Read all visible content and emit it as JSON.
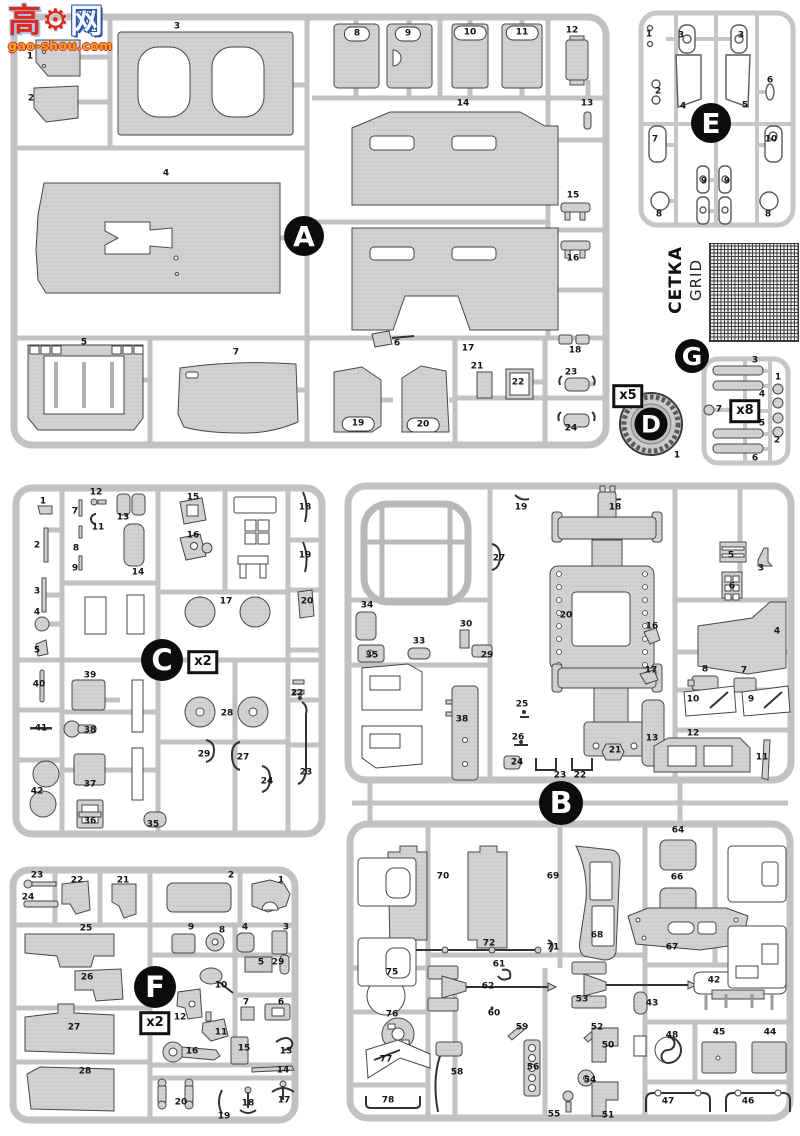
{
  "watermark": {
    "char_left": "高",
    "char_right": "网",
    "gear_glyph": "⚙",
    "url": "gao-shou.com"
  },
  "grid_part": {
    "label_cyrillic": "СЕТКА",
    "label_english": "GRID"
  },
  "sprues": {
    "a": {
      "letter": "A"
    },
    "b": {
      "letter": "B"
    },
    "c": {
      "letter": "C",
      "multiplier": "x2"
    },
    "d": {
      "letter": "D",
      "multiplier": "x5"
    },
    "e": {
      "letter": "E"
    },
    "f": {
      "letter": "F",
      "multiplier": "x2"
    },
    "g": {
      "letter": "G",
      "multiplier": "x8"
    }
  },
  "part_labels": [
    {
      "s": "A",
      "n": "1",
      "x": 30,
      "y": 57
    },
    {
      "s": "A",
      "n": "2",
      "x": 31,
      "y": 99
    },
    {
      "s": "A",
      "n": "3",
      "x": 177,
      "y": 27
    },
    {
      "s": "A",
      "n": "4",
      "x": 166,
      "y": 174
    },
    {
      "s": "A",
      "n": "5",
      "x": 84,
      "y": 343
    },
    {
      "s": "A",
      "n": "6",
      "x": 397,
      "y": 344
    },
    {
      "s": "A",
      "n": "7",
      "x": 236,
      "y": 353
    },
    {
      "s": "A",
      "n": "8",
      "x": 357,
      "y": 34,
      "pill": 1
    },
    {
      "s": "A",
      "n": "9",
      "x": 408,
      "y": 34,
      "pill": 1
    },
    {
      "s": "A",
      "n": "10",
      "x": 470,
      "y": 33,
      "pill": 1
    },
    {
      "s": "A",
      "n": "11",
      "x": 522,
      "y": 33,
      "pill": 1
    },
    {
      "s": "A",
      "n": "12",
      "x": 572,
      "y": 31
    },
    {
      "s": "A",
      "n": "13",
      "x": 587,
      "y": 104
    },
    {
      "s": "A",
      "n": "14",
      "x": 463,
      "y": 104
    },
    {
      "s": "A",
      "n": "15",
      "x": 573,
      "y": 196
    },
    {
      "s": "A",
      "n": "16",
      "x": 573,
      "y": 259
    },
    {
      "s": "A",
      "n": "17",
      "x": 468,
      "y": 349
    },
    {
      "s": "A",
      "n": "18",
      "x": 575,
      "y": 351
    },
    {
      "s": "A",
      "n": "19",
      "x": 358,
      "y": 424,
      "pill": 1
    },
    {
      "s": "A",
      "n": "20",
      "x": 423,
      "y": 425,
      "pill": 1
    },
    {
      "s": "A",
      "n": "21",
      "x": 477,
      "y": 367
    },
    {
      "s": "A",
      "n": "22",
      "x": 518,
      "y": 383
    },
    {
      "s": "A",
      "n": "23",
      "x": 571,
      "y": 373
    },
    {
      "s": "A",
      "n": "24",
      "x": 571,
      "y": 429
    },
    {
      "s": "E",
      "n": "1",
      "x": 649,
      "y": 35
    },
    {
      "s": "E",
      "n": "2",
      "x": 658,
      "y": 92
    },
    {
      "s": "E",
      "n": "3",
      "x": 681,
      "y": 36
    },
    {
      "s": "E",
      "n": "3",
      "x": 741,
      "y": 36
    },
    {
      "s": "E",
      "n": "4",
      "x": 683,
      "y": 107
    },
    {
      "s": "E",
      "n": "5",
      "x": 745,
      "y": 106
    },
    {
      "s": "E",
      "n": "6",
      "x": 770,
      "y": 81
    },
    {
      "s": "E",
      "n": "7",
      "x": 655,
      "y": 140
    },
    {
      "s": "E",
      "n": "8",
      "x": 659,
      "y": 215
    },
    {
      "s": "E",
      "n": "8",
      "x": 768,
      "y": 215
    },
    {
      "s": "E",
      "n": "9",
      "x": 704,
      "y": 182
    },
    {
      "s": "E",
      "n": "9",
      "x": 727,
      "y": 182
    },
    {
      "s": "E",
      "n": "10",
      "x": 771,
      "y": 140
    },
    {
      "s": "G",
      "n": "3",
      "x": 755,
      "y": 361
    },
    {
      "s": "G",
      "n": "1",
      "x": 778,
      "y": 378
    },
    {
      "s": "G",
      "n": "4",
      "x": 762,
      "y": 395
    },
    {
      "s": "G",
      "n": "7",
      "x": 719,
      "y": 410
    },
    {
      "s": "G",
      "n": "5",
      "x": 762,
      "y": 424
    },
    {
      "s": "G",
      "n": "2",
      "x": 777,
      "y": 441
    },
    {
      "s": "G",
      "n": "6",
      "x": 755,
      "y": 459
    },
    {
      "s": "D",
      "n": "1",
      "x": 677,
      "y": 456
    },
    {
      "s": "C",
      "n": "1",
      "x": 43,
      "y": 502
    },
    {
      "s": "C",
      "n": "7",
      "x": 75,
      "y": 512
    },
    {
      "s": "C",
      "n": "12",
      "x": 96,
      "y": 493
    },
    {
      "s": "C",
      "n": "13",
      "x": 123,
      "y": 518
    },
    {
      "s": "C",
      "n": "11",
      "x": 98,
      "y": 528
    },
    {
      "s": "C",
      "n": "15",
      "x": 193,
      "y": 498
    },
    {
      "s": "C",
      "n": "18",
      "x": 305,
      "y": 508
    },
    {
      "s": "C",
      "n": "2",
      "x": 37,
      "y": 546
    },
    {
      "s": "C",
      "n": "8",
      "x": 76,
      "y": 549
    },
    {
      "s": "C",
      "n": "16",
      "x": 193,
      "y": 536
    },
    {
      "s": "C",
      "n": "19",
      "x": 305,
      "y": 556
    },
    {
      "s": "C",
      "n": "9",
      "x": 75,
      "y": 569
    },
    {
      "s": "C",
      "n": "14",
      "x": 138,
      "y": 573
    },
    {
      "s": "C",
      "n": "3",
      "x": 37,
      "y": 592
    },
    {
      "s": "C",
      "n": "17",
      "x": 226,
      "y": 602
    },
    {
      "s": "C",
      "n": "20",
      "x": 307,
      "y": 602
    },
    {
      "s": "C",
      "n": "4",
      "x": 37,
      "y": 613
    },
    {
      "s": "C",
      "n": "5",
      "x": 37,
      "y": 651
    },
    {
      "s": "C",
      "n": "40",
      "x": 39,
      "y": 685
    },
    {
      "s": "C",
      "n": "39",
      "x": 90,
      "y": 676
    },
    {
      "s": "C",
      "n": "22",
      "x": 297,
      "y": 694
    },
    {
      "s": "C",
      "n": "41",
      "x": 41,
      "y": 729
    },
    {
      "s": "C",
      "n": "38",
      "x": 90,
      "y": 731
    },
    {
      "s": "C",
      "n": "28",
      "x": 227,
      "y": 714
    },
    {
      "s": "C",
      "n": "29",
      "x": 204,
      "y": 755
    },
    {
      "s": "C",
      "n": "27",
      "x": 243,
      "y": 758
    },
    {
      "s": "C",
      "n": "23",
      "x": 306,
      "y": 773
    },
    {
      "s": "C",
      "n": "24",
      "x": 267,
      "y": 782
    },
    {
      "s": "C",
      "n": "37",
      "x": 90,
      "y": 785
    },
    {
      "s": "C",
      "n": "42",
      "x": 37,
      "y": 792
    },
    {
      "s": "C",
      "n": "36",
      "x": 90,
      "y": 822
    },
    {
      "s": "C",
      "n": "35",
      "x": 153,
      "y": 825
    },
    {
      "s": "B",
      "n": "19",
      "x": 521,
      "y": 508
    },
    {
      "s": "B",
      "n": "18",
      "x": 615,
      "y": 508
    },
    {
      "s": "B",
      "n": "27",
      "x": 499,
      "y": 559
    },
    {
      "s": "B",
      "n": "34",
      "x": 367,
      "y": 606
    },
    {
      "s": "B",
      "n": "30",
      "x": 466,
      "y": 625
    },
    {
      "s": "B",
      "n": "20",
      "x": 566,
      "y": 616
    },
    {
      "s": "B",
      "n": "33",
      "x": 419,
      "y": 642
    },
    {
      "s": "B",
      "n": "5",
      "x": 731,
      "y": 556
    },
    {
      "s": "B",
      "n": "3",
      "x": 761,
      "y": 569
    },
    {
      "s": "B",
      "n": "6",
      "x": 732,
      "y": 587
    },
    {
      "s": "B",
      "n": "16",
      "x": 652,
      "y": 627
    },
    {
      "s": "B",
      "n": "4",
      "x": 777,
      "y": 632
    },
    {
      "s": "B",
      "n": "35",
      "x": 372,
      "y": 656
    },
    {
      "s": "B",
      "n": "29",
      "x": 487,
      "y": 656
    },
    {
      "s": "B",
      "n": "17",
      "x": 651,
      "y": 671
    },
    {
      "s": "B",
      "n": "8",
      "x": 705,
      "y": 670
    },
    {
      "s": "B",
      "n": "7",
      "x": 744,
      "y": 671
    },
    {
      "s": "B",
      "n": "38",
      "x": 462,
      "y": 720
    },
    {
      "s": "B",
      "n": "25",
      "x": 522,
      "y": 705
    },
    {
      "s": "B",
      "n": "10",
      "x": 693,
      "y": 700
    },
    {
      "s": "B",
      "n": "9",
      "x": 751,
      "y": 700
    },
    {
      "s": "B",
      "n": "13",
      "x": 652,
      "y": 739
    },
    {
      "s": "B",
      "n": "12",
      "x": 693,
      "y": 734
    },
    {
      "s": "B",
      "n": "26",
      "x": 518,
      "y": 738
    },
    {
      "s": "B",
      "n": "24",
      "x": 517,
      "y": 763
    },
    {
      "s": "B",
      "n": "23",
      "x": 560,
      "y": 776
    },
    {
      "s": "B",
      "n": "22",
      "x": 580,
      "y": 776
    },
    {
      "s": "B",
      "n": "21",
      "x": 615,
      "y": 751
    },
    {
      "s": "B",
      "n": "11",
      "x": 762,
      "y": 758
    },
    {
      "s": "B",
      "n": "70",
      "x": 443,
      "y": 877
    },
    {
      "s": "B",
      "n": "69",
      "x": 553,
      "y": 877
    },
    {
      "s": "B",
      "n": "68",
      "x": 597,
      "y": 936
    },
    {
      "s": "B",
      "n": "72",
      "x": 489,
      "y": 944
    },
    {
      "s": "B",
      "n": "71",
      "x": 553,
      "y": 948
    },
    {
      "s": "B",
      "n": "64",
      "x": 678,
      "y": 831
    },
    {
      "s": "B",
      "n": "66",
      "x": 677,
      "y": 878
    },
    {
      "s": "B",
      "n": "67",
      "x": 672,
      "y": 948
    },
    {
      "s": "B",
      "n": "75",
      "x": 392,
      "y": 973
    },
    {
      "s": "B",
      "n": "61",
      "x": 499,
      "y": 965
    },
    {
      "s": "B",
      "n": "62",
      "x": 488,
      "y": 987
    },
    {
      "s": "B",
      "n": "53",
      "x": 582,
      "y": 1000
    },
    {
      "s": "B",
      "n": "60",
      "x": 494,
      "y": 1014
    },
    {
      "s": "B",
      "n": "59",
      "x": 522,
      "y": 1028
    },
    {
      "s": "B",
      "n": "52",
      "x": 597,
      "y": 1028
    },
    {
      "s": "B",
      "n": "43",
      "x": 652,
      "y": 1004
    },
    {
      "s": "B",
      "n": "42",
      "x": 714,
      "y": 981
    },
    {
      "s": "B",
      "n": "76",
      "x": 392,
      "y": 1015
    },
    {
      "s": "B",
      "n": "77",
      "x": 386,
      "y": 1060
    },
    {
      "s": "B",
      "n": "78",
      "x": 388,
      "y": 1101
    },
    {
      "s": "B",
      "n": "58",
      "x": 457,
      "y": 1073
    },
    {
      "s": "B",
      "n": "56",
      "x": 533,
      "y": 1068
    },
    {
      "s": "B",
      "n": "54",
      "x": 590,
      "y": 1081
    },
    {
      "s": "B",
      "n": "55",
      "x": 554,
      "y": 1115
    },
    {
      "s": "B",
      "n": "50",
      "x": 608,
      "y": 1046
    },
    {
      "s": "B",
      "n": "51",
      "x": 608,
      "y": 1116
    },
    {
      "s": "B",
      "n": "48",
      "x": 672,
      "y": 1036
    },
    {
      "s": "B",
      "n": "45",
      "x": 719,
      "y": 1033
    },
    {
      "s": "B",
      "n": "44",
      "x": 770,
      "y": 1033
    },
    {
      "s": "B",
      "n": "47",
      "x": 668,
      "y": 1102
    },
    {
      "s": "B",
      "n": "46",
      "x": 748,
      "y": 1102
    },
    {
      "s": "F",
      "n": "23",
      "x": 37,
      "y": 876
    },
    {
      "s": "F",
      "n": "24",
      "x": 28,
      "y": 898
    },
    {
      "s": "F",
      "n": "22",
      "x": 77,
      "y": 881
    },
    {
      "s": "F",
      "n": "21",
      "x": 123,
      "y": 881
    },
    {
      "s": "F",
      "n": "2",
      "x": 231,
      "y": 876
    },
    {
      "s": "F",
      "n": "1",
      "x": 281,
      "y": 881
    },
    {
      "s": "F",
      "n": "25",
      "x": 86,
      "y": 929
    },
    {
      "s": "F",
      "n": "9",
      "x": 191,
      "y": 928
    },
    {
      "s": "F",
      "n": "8",
      "x": 222,
      "y": 931
    },
    {
      "s": "F",
      "n": "4",
      "x": 245,
      "y": 928
    },
    {
      "s": "F",
      "n": "3",
      "x": 286,
      "y": 928
    },
    {
      "s": "F",
      "n": "5",
      "x": 261,
      "y": 963
    },
    {
      "s": "F",
      "n": "29",
      "x": 278,
      "y": 963
    },
    {
      "s": "F",
      "n": "26",
      "x": 87,
      "y": 978
    },
    {
      "s": "F",
      "n": "10",
      "x": 221,
      "y": 986
    },
    {
      "s": "F",
      "n": "12",
      "x": 180,
      "y": 1018
    },
    {
      "s": "F",
      "n": "27",
      "x": 74,
      "y": 1028
    },
    {
      "s": "F",
      "n": "11",
      "x": 221,
      "y": 1033
    },
    {
      "s": "F",
      "n": "7",
      "x": 246,
      "y": 1003
    },
    {
      "s": "F",
      "n": "6",
      "x": 281,
      "y": 1003
    },
    {
      "s": "F",
      "n": "16",
      "x": 192,
      "y": 1052
    },
    {
      "s": "F",
      "n": "15",
      "x": 244,
      "y": 1049
    },
    {
      "s": "F",
      "n": "13",
      "x": 286,
      "y": 1052
    },
    {
      "s": "F",
      "n": "14",
      "x": 283,
      "y": 1071
    },
    {
      "s": "F",
      "n": "28",
      "x": 85,
      "y": 1072
    },
    {
      "s": "F",
      "n": "20",
      "x": 181,
      "y": 1103
    },
    {
      "s": "F",
      "n": "19",
      "x": 224,
      "y": 1117
    },
    {
      "s": "F",
      "n": "18",
      "x": 248,
      "y": 1104
    },
    {
      "s": "F",
      "n": "17",
      "x": 284,
      "y": 1101
    }
  ]
}
